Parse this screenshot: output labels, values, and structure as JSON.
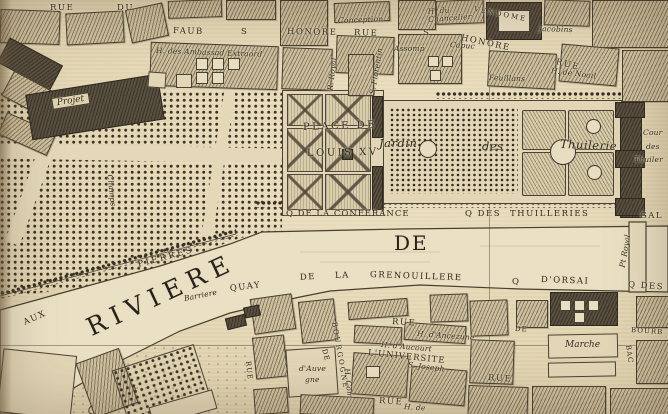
{
  "map_type": "antique engraved city map (Paris, Tuileries / Place de Louis XV detail)",
  "palette": {
    "parchment": "#e3d6b3",
    "ink": "#2e2821",
    "block_fill": "#cfc09e",
    "dark_building": "#5a5040",
    "water": "#eae0c4"
  },
  "labels": [
    {
      "text": "RUE",
      "kind": "street"
    },
    {
      "text": "DU",
      "kind": "street"
    },
    {
      "text": "FAUB",
      "kind": "street"
    },
    {
      "text": "S",
      "kind": "street"
    },
    {
      "text": "HONORE",
      "kind": "street"
    },
    {
      "text": "RUE",
      "kind": "street"
    },
    {
      "text": "Conception",
      "kind": "building"
    },
    {
      "text": "H. des Ambassad Extraord",
      "kind": "building"
    },
    {
      "text": "R. Royal",
      "kind": "street"
    },
    {
      "text": "S. Florentin",
      "kind": "street"
    },
    {
      "text": "Assomp",
      "kind": "building"
    },
    {
      "text": "S",
      "kind": "street"
    },
    {
      "text": "HONORE",
      "kind": "street"
    },
    {
      "text": "RUE",
      "kind": "street"
    },
    {
      "text": "Capuc",
      "kind": "building"
    },
    {
      "text": "H. du Chancelier",
      "kind": "building"
    },
    {
      "text": "VENDOME",
      "kind": "place"
    },
    {
      "text": "Jacobins",
      "kind": "building"
    },
    {
      "text": "Feuillans",
      "kind": "building"
    },
    {
      "text": "H. de Noail",
      "kind": "building"
    },
    {
      "text": "Projet",
      "kind": "area"
    },
    {
      "text": "PLACE DE",
      "kind": "place"
    },
    {
      "text": "LOUIS XV",
      "kind": "place"
    },
    {
      "text": "Jardin",
      "kind": "garden"
    },
    {
      "text": "des",
      "kind": "garden"
    },
    {
      "text": "Thuilerie",
      "kind": "garden"
    },
    {
      "text": "Cour",
      "kind": "place"
    },
    {
      "text": "des",
      "kind": "place"
    },
    {
      "text": "Thuiler",
      "kind": "place"
    },
    {
      "text": "Q DE LA CONFERANCE",
      "kind": "quai"
    },
    {
      "text": "Q DES",
      "kind": "quai"
    },
    {
      "text": "THUILLERIES",
      "kind": "quai"
    },
    {
      "text": "GAL",
      "kind": "quai"
    },
    {
      "text": "DE",
      "kind": "water"
    },
    {
      "text": "RIVIERE",
      "kind": "water"
    },
    {
      "text": "PIERRES",
      "kind": "street"
    },
    {
      "text": "AUX",
      "kind": "street"
    },
    {
      "text": "Barriere",
      "kind": "landmark"
    },
    {
      "text": "QUAY",
      "kind": "quai"
    },
    {
      "text": "DE",
      "kind": "quai"
    },
    {
      "text": "LA",
      "kind": "quai"
    },
    {
      "text": "GRENOUILLERE",
      "kind": "quai"
    },
    {
      "text": "Q",
      "kind": "quai"
    },
    {
      "text": "D'ORSAI",
      "kind": "quai"
    },
    {
      "text": "Q DES",
      "kind": "quai"
    },
    {
      "text": "Pt Royal",
      "kind": "bridge"
    },
    {
      "text": "BOURB",
      "kind": "quai"
    },
    {
      "text": "Marche",
      "kind": "building"
    },
    {
      "text": "BAC",
      "kind": "street"
    },
    {
      "text": "DE",
      "kind": "street"
    },
    {
      "text": "RUE",
      "kind": "street"
    },
    {
      "text": "H. d'Ancezune",
      "kind": "building"
    },
    {
      "text": "H. d'Aucourt",
      "kind": "building"
    },
    {
      "text": "L'UNIVERSITE",
      "kind": "street"
    },
    {
      "text": "S. Joseph",
      "kind": "building"
    },
    {
      "text": "BOURGOGNE",
      "kind": "street"
    },
    {
      "text": "DE",
      "kind": "street"
    },
    {
      "text": "d'Auve",
      "kind": "building"
    },
    {
      "text": "gne",
      "kind": "building"
    },
    {
      "text": "H. Com",
      "kind": "building"
    },
    {
      "text": "RUE",
      "kind": "street"
    },
    {
      "text": "H. de",
      "kind": "building"
    },
    {
      "text": "RUE",
      "kind": "street"
    },
    {
      "text": "RUE",
      "kind": "street"
    },
    {
      "text": "Champs",
      "kind": "area"
    }
  ]
}
